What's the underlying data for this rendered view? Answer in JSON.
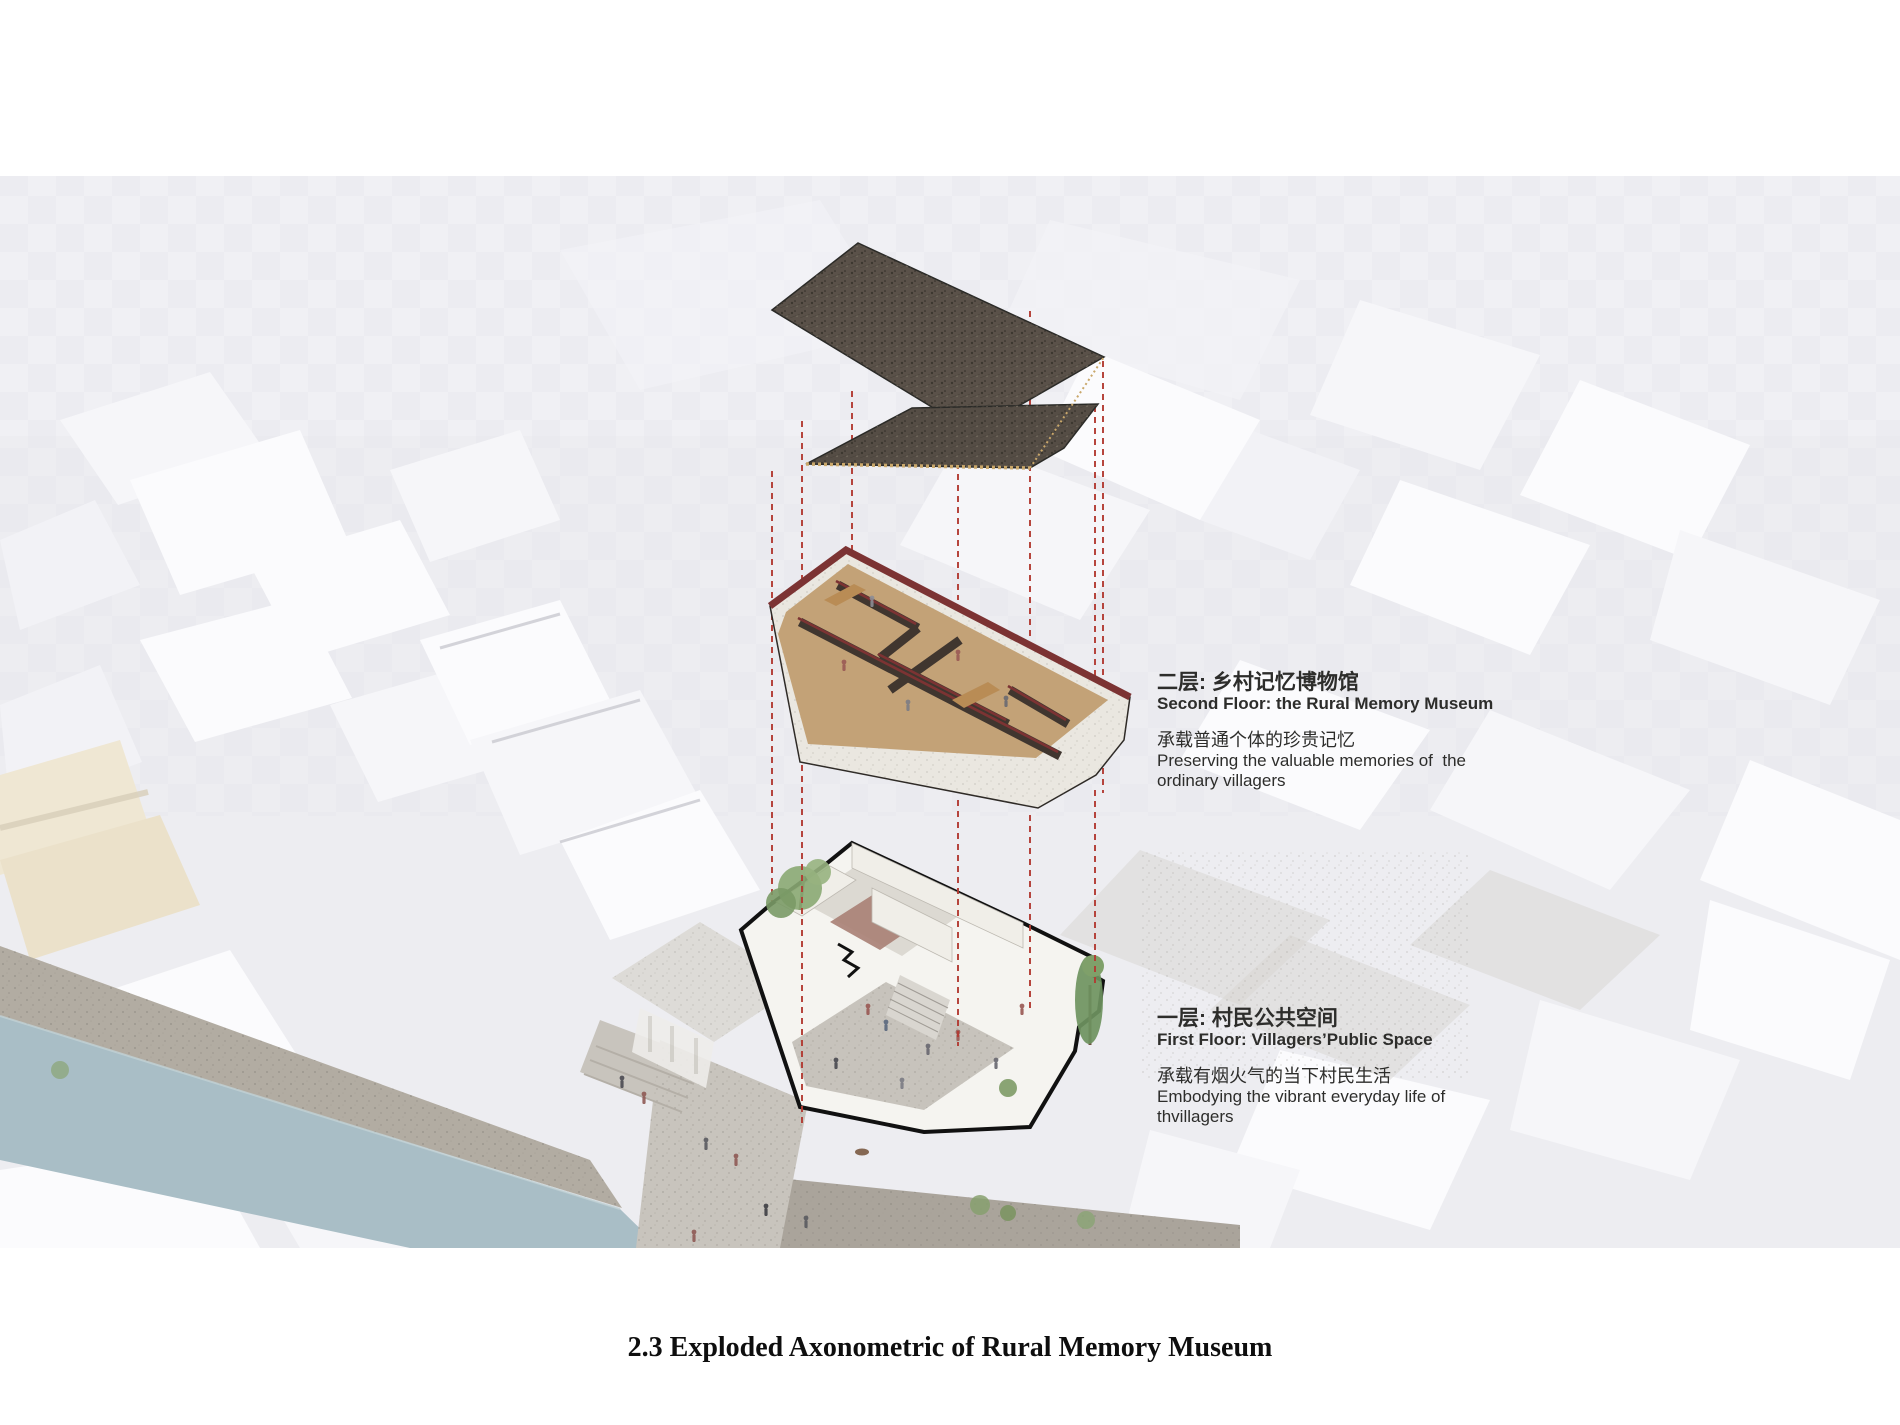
{
  "page": {
    "caption": "2.3 Exploded Axonometric of Rural Memory Museum"
  },
  "annotations": {
    "second_floor": {
      "title_cn": "二层: 乡村记忆博物馆",
      "title_en": "Second Floor: the Rural Memory Museum",
      "desc_cn": "承载普通个体的珍贵记忆",
      "desc_en_line1": "Preserving the valuable memories of  the",
      "desc_en_line2": "ordinary villagers"
    },
    "first_floor": {
      "title_cn": "一层: 村民公共空间",
      "title_en": "First Floor: Villagers’Public Space",
      "desc_cn": "承载有烟火气的当下村民生活",
      "desc_en_line1": "Embodying the vibrant everyday life of",
      "desc_en_line2": "thvillagers"
    }
  },
  "drawing": {
    "layers": [
      "roof",
      "second floor",
      "first floor"
    ],
    "colors": {
      "background": "#ecedf1",
      "projection_line_red": "#b23b33",
      "roof_dark": "#5a5149",
      "roof_eave_tan": "#c9a76a",
      "parapet_maroon": "#7c3333",
      "interior_wall_dark": "#40362f",
      "wood_floor": "#c3a277",
      "stone_base": "#eae7e0",
      "plan_outline_black": "#111111",
      "courtyard_stone": "#c7c3bc",
      "terrace_red": "#a87f74",
      "tree_green": "#8aa873",
      "river_blue": "#a9bec6",
      "embankment_stone": "#b2aca2",
      "context_white": "#fbfbfd",
      "context_beige": "#efe7d3"
    }
  }
}
